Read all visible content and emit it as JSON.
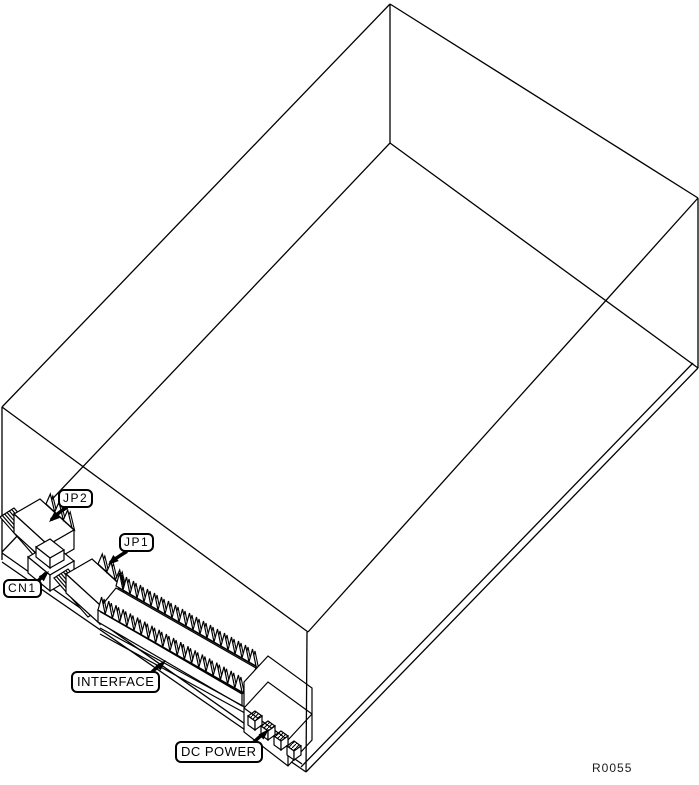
{
  "figure": {
    "background_color": "#ffffff",
    "line_color": "#000000",
    "ref_code": "R0055",
    "callouts": {
      "jp2": "JP2",
      "jp1": "JP1",
      "cn1": "CN1",
      "interface": "INTERFACE",
      "dc_power": "DC POWER"
    }
  }
}
